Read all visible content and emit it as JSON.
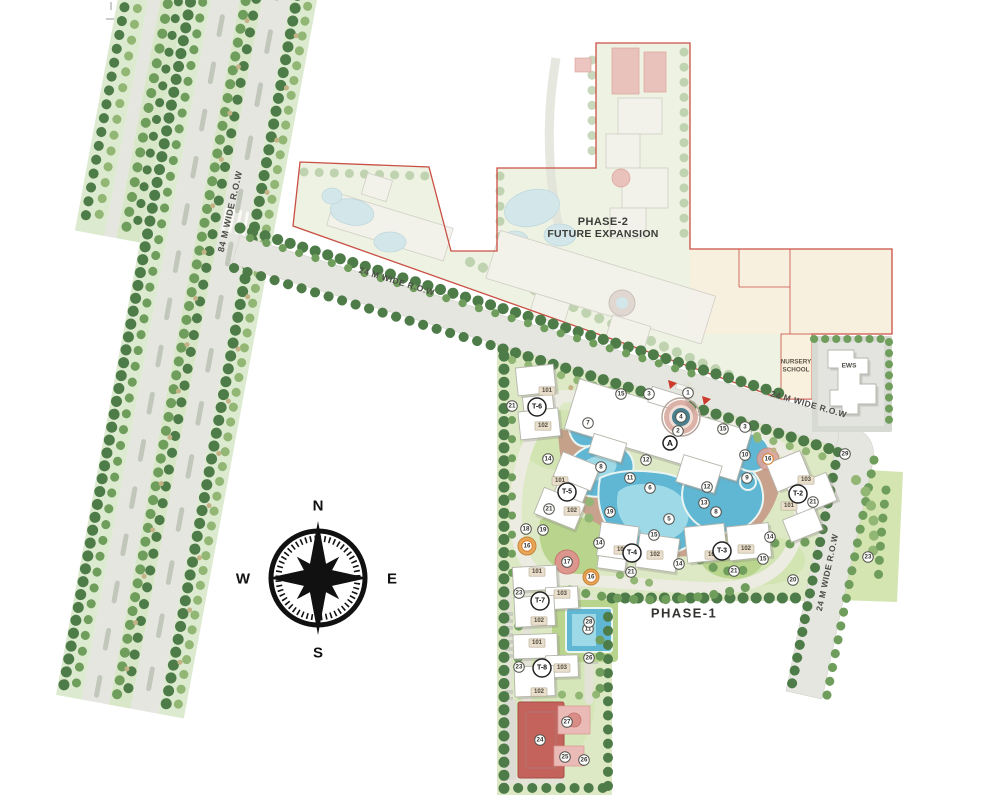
{
  "compass": {
    "north": "N",
    "south": "S",
    "east": "E",
    "west": "W"
  },
  "roads": {
    "highway_label": "84 M WIDE R.O.W",
    "r24_upper_label": "24 M WIDE R.O.W",
    "r24_east_label": "24 M WIDE R.O.W",
    "r24_south_label": "24 M WIDE R.O.W"
  },
  "zones": {
    "phase1_label": "PHASE-1",
    "phase2_title": "PHASE-2",
    "phase2_subtitle": "FUTURE EXPANSION",
    "nursery_line1": "NURSERY",
    "nursery_line2": "SCHOOL",
    "ews_label": "EWS",
    "clubhouse_marker": "A"
  },
  "towers": [
    {
      "id": "T-6",
      "x": 537,
      "y": 407,
      "units": [
        {
          "label": "101",
          "x": 547,
          "y": 391
        },
        {
          "label": "102",
          "x": 543,
          "y": 426
        }
      ]
    },
    {
      "id": "T-5",
      "x": 567,
      "y": 492,
      "units": [
        {
          "label": "101",
          "x": 560,
          "y": 481
        },
        {
          "label": "102",
          "x": 572,
          "y": 511
        }
      ]
    },
    {
      "id": "T-4",
      "x": 632,
      "y": 553,
      "units": [
        {
          "label": "101",
          "x": 622,
          "y": 550
        },
        {
          "label": "102",
          "x": 655,
          "y": 555
        }
      ]
    },
    {
      "id": "T-3",
      "x": 722,
      "y": 551,
      "units": [
        {
          "label": "101",
          "x": 713,
          "y": 555
        },
        {
          "label": "102",
          "x": 746,
          "y": 549
        }
      ]
    },
    {
      "id": "T-2",
      "x": 798,
      "y": 494,
      "units": [
        {
          "label": "103",
          "x": 806,
          "y": 480
        },
        {
          "label": "101",
          "x": 789,
          "y": 506
        }
      ]
    },
    {
      "id": "T-7",
      "x": 540,
      "y": 601,
      "units": [
        {
          "label": "101",
          "x": 537,
          "y": 572
        },
        {
          "label": "103",
          "x": 562,
          "y": 594
        },
        {
          "label": "102",
          "x": 539,
          "y": 621
        }
      ]
    },
    {
      "id": "T-8",
      "x": 542,
      "y": 668,
      "units": [
        {
          "label": "101",
          "x": 537,
          "y": 643
        },
        {
          "label": "103",
          "x": 562,
          "y": 668
        },
        {
          "label": "102",
          "x": 539,
          "y": 692
        }
      ]
    }
  ],
  "markers": [
    {
      "label": "1",
      "x": 688,
      "y": 393
    },
    {
      "label": "2",
      "x": 678,
      "y": 431
    },
    {
      "label": "3",
      "x": 649,
      "y": 394
    },
    {
      "label": "3",
      "x": 745,
      "y": 427
    },
    {
      "label": "4",
      "x": 681,
      "y": 417
    },
    {
      "label": "5",
      "x": 669,
      "y": 519
    },
    {
      "label": "6",
      "x": 650,
      "y": 488
    },
    {
      "label": "7",
      "x": 588,
      "y": 423
    },
    {
      "label": "8",
      "x": 601,
      "y": 467
    },
    {
      "label": "8",
      "x": 716,
      "y": 512
    },
    {
      "label": "9",
      "x": 747,
      "y": 478
    },
    {
      "label": "10",
      "x": 745,
      "y": 455
    },
    {
      "label": "11",
      "x": 630,
      "y": 478
    },
    {
      "label": "11",
      "x": 588,
      "y": 629
    },
    {
      "label": "12",
      "x": 646,
      "y": 460
    },
    {
      "label": "12",
      "x": 707,
      "y": 487
    },
    {
      "label": "13",
      "x": 704,
      "y": 503
    },
    {
      "label": "14",
      "x": 548,
      "y": 459
    },
    {
      "label": "14",
      "x": 599,
      "y": 543
    },
    {
      "label": "14",
      "x": 679,
      "y": 564
    },
    {
      "label": "14",
      "x": 770,
      "y": 537
    },
    {
      "label": "15",
      "x": 621,
      "y": 394
    },
    {
      "label": "15",
      "x": 723,
      "y": 429
    },
    {
      "label": "15",
      "x": 654,
      "y": 535
    },
    {
      "label": "15",
      "x": 763,
      "y": 559
    },
    {
      "label": "16",
      "x": 768,
      "y": 459,
      "style": "orange"
    },
    {
      "label": "16",
      "x": 527,
      "y": 546,
      "style": "orange"
    },
    {
      "label": "16",
      "x": 591,
      "y": 577,
      "style": "orange"
    },
    {
      "label": "17",
      "x": 567,
      "y": 562
    },
    {
      "label": "18",
      "x": 526,
      "y": 529
    },
    {
      "label": "19",
      "x": 543,
      "y": 530
    },
    {
      "label": "19",
      "x": 610,
      "y": 512
    },
    {
      "label": "20",
      "x": 793,
      "y": 580
    },
    {
      "label": "21",
      "x": 512,
      "y": 406
    },
    {
      "label": "21",
      "x": 549,
      "y": 509
    },
    {
      "label": "21",
      "x": 631,
      "y": 572
    },
    {
      "label": "21",
      "x": 734,
      "y": 571
    },
    {
      "label": "21",
      "x": 813,
      "y": 502
    },
    {
      "label": "23",
      "x": 519,
      "y": 593
    },
    {
      "label": "23",
      "x": 519,
      "y": 667
    },
    {
      "label": "23",
      "x": 868,
      "y": 557
    },
    {
      "label": "24",
      "x": 540,
      "y": 740
    },
    {
      "label": "25",
      "x": 565,
      "y": 757
    },
    {
      "label": "26",
      "x": 589,
      "y": 658
    },
    {
      "label": "26",
      "x": 584,
      "y": 760
    },
    {
      "label": "27",
      "x": 567,
      "y": 722
    },
    {
      "label": "28",
      "x": 589,
      "y": 622
    },
    {
      "label": "29",
      "x": 845,
      "y": 454
    }
  ]
}
